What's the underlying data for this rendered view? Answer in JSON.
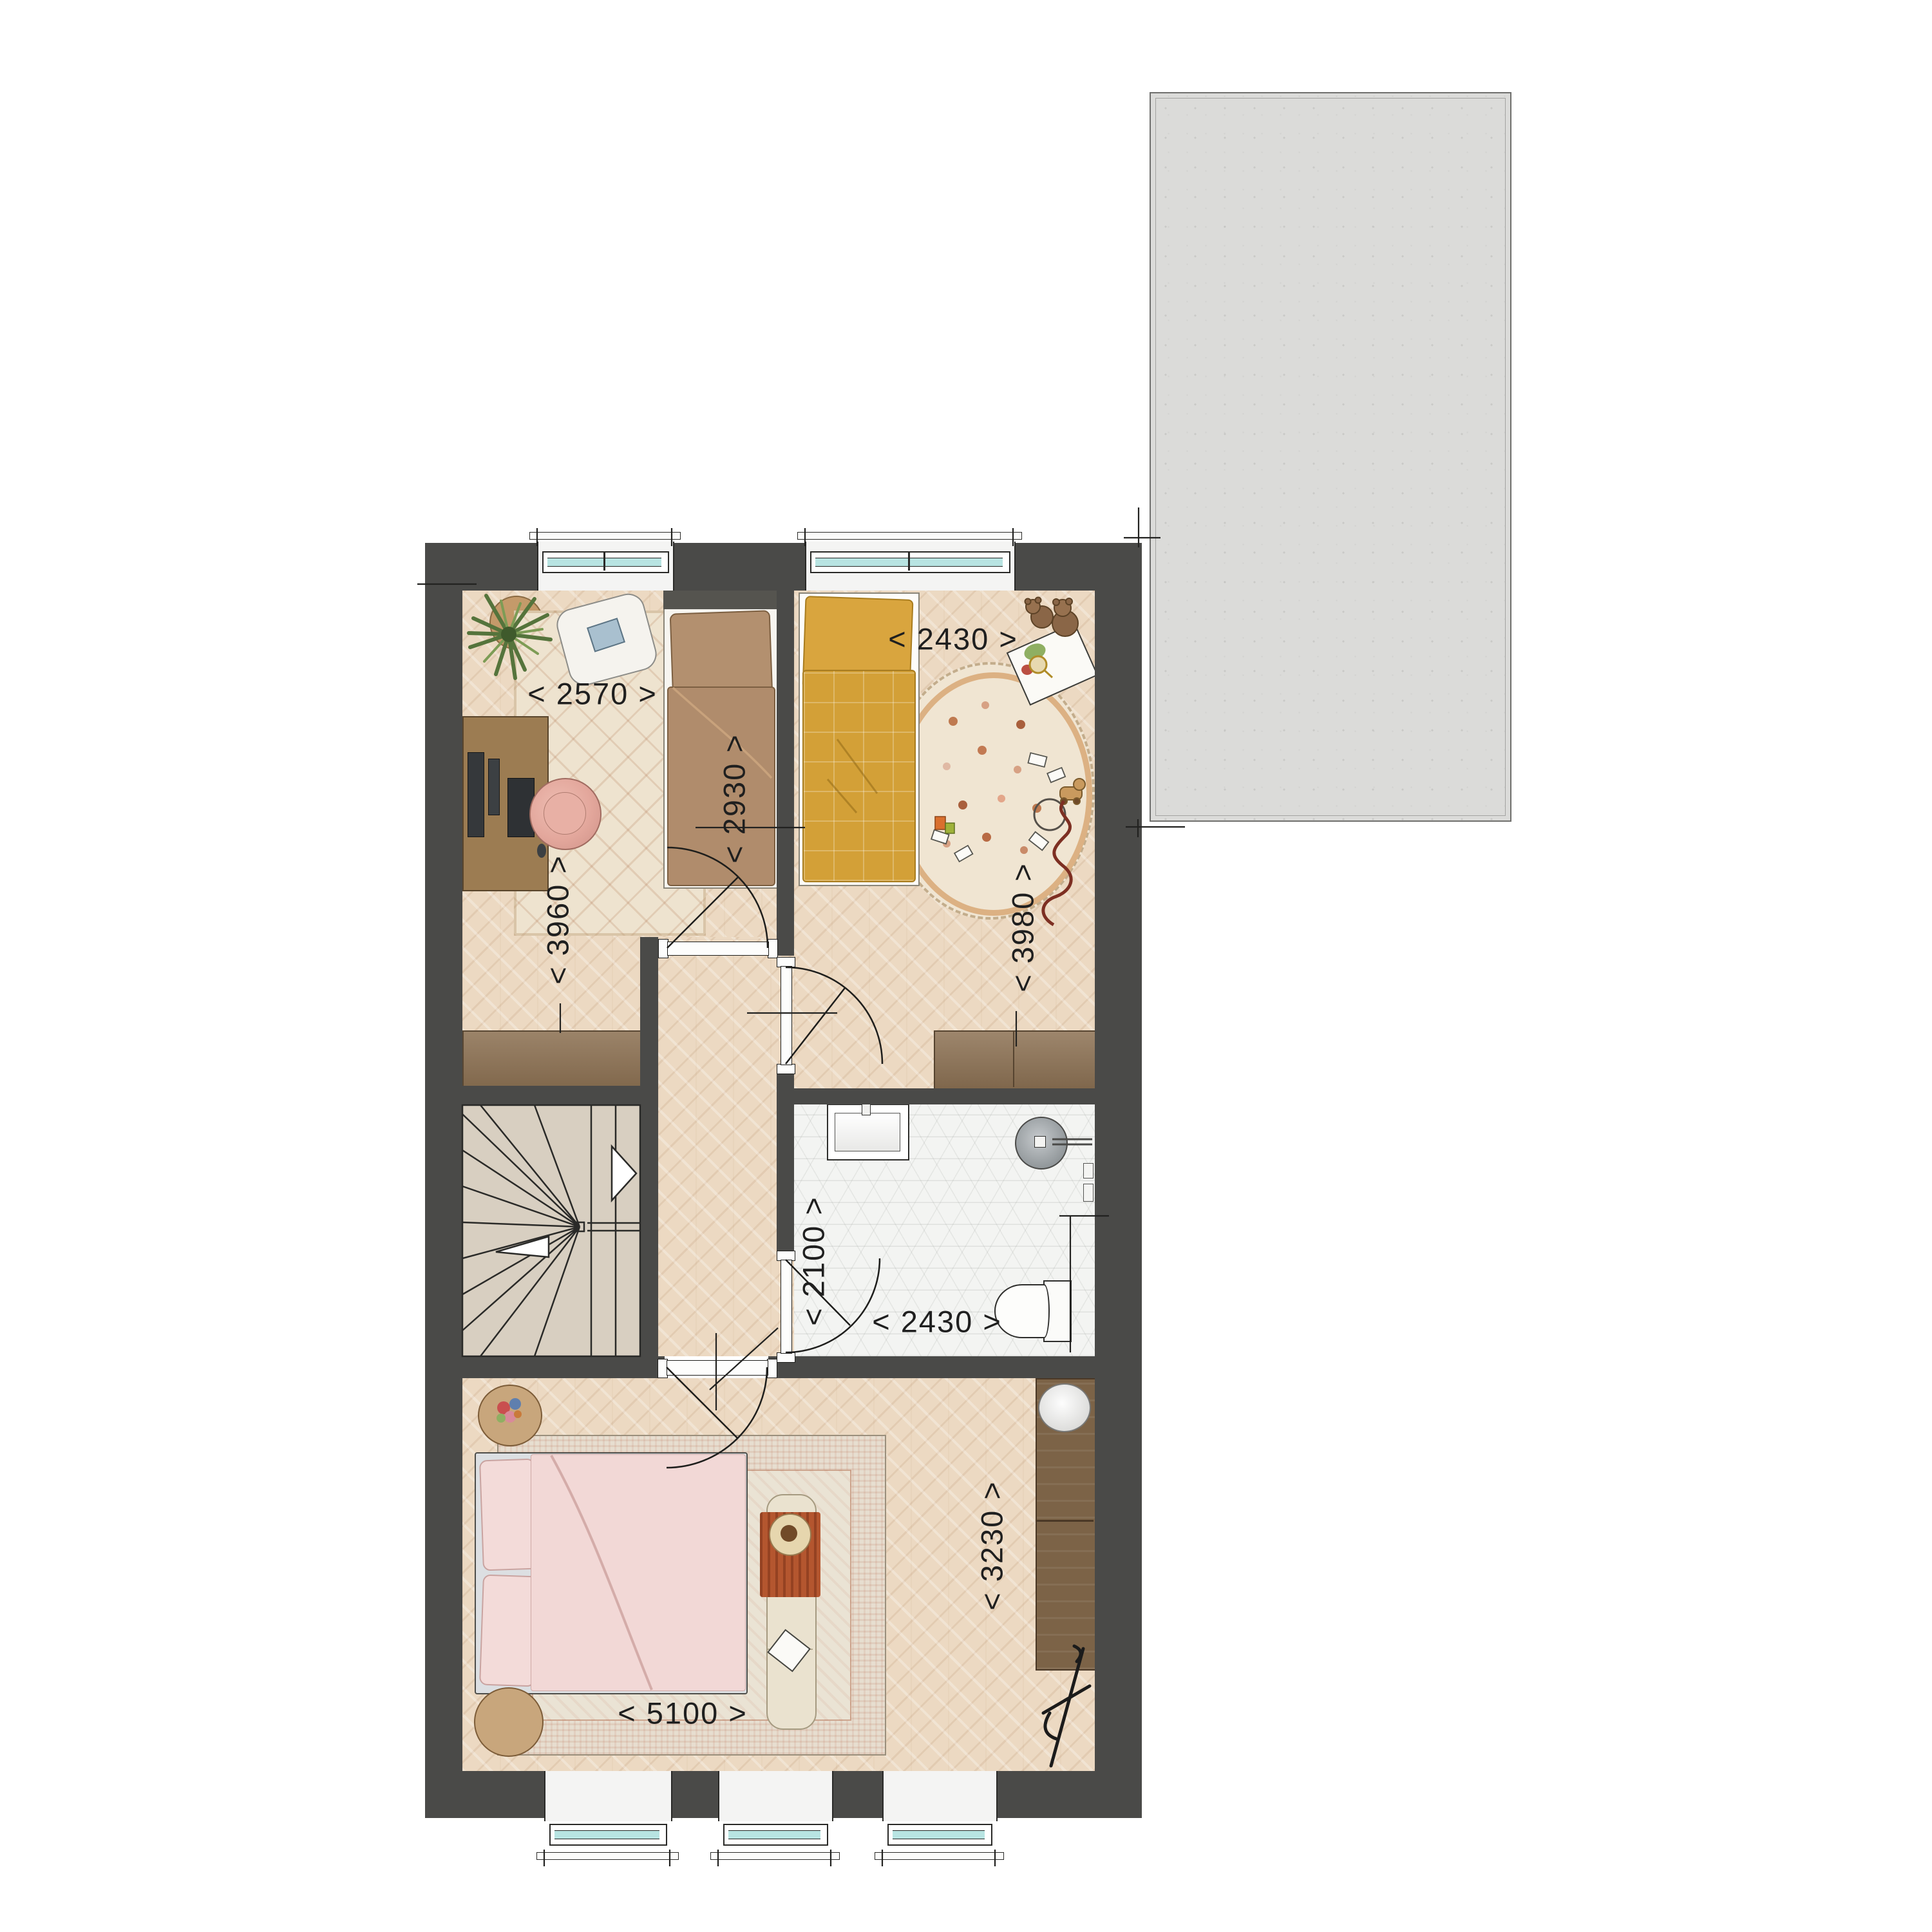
{
  "colors": {
    "wall": "#4a4a48",
    "wood-floor": "#ecd9c2",
    "tile-floor": "#f3f4f2",
    "stair-floor": "#d8cfc1",
    "terrace": "#dbdbd9",
    "furniture-wood": "#8d7254",
    "wardrobe-wood": "#7c6347",
    "window-glass": "#b8e4e2",
    "master-bed": "#f2d8d6",
    "kids-bed": "#d3a037",
    "guest-bed": "#b08c6c",
    "throw": "#b4562f",
    "chair": "#e3a79c",
    "dim-text": "#1f1f1f"
  },
  "labels": [
    {
      "id": "bedroom1-width",
      "text": "< 2570 >",
      "orientation": "horizontal"
    },
    {
      "id": "bedroom1-bed-length",
      "text": "< 2930 >",
      "orientation": "vertical"
    },
    {
      "id": "kidsroom-width",
      "text": "< 2430 >",
      "orientation": "horizontal"
    },
    {
      "id": "kidsroom-depth",
      "text": "< 3980 >",
      "orientation": "vertical"
    },
    {
      "id": "bedroom1-depth",
      "text": "< 3960 >",
      "orientation": "vertical"
    },
    {
      "id": "bathroom-depth",
      "text": "< 2100 >",
      "orientation": "vertical"
    },
    {
      "id": "bathroom-width",
      "text": "< 2430 >",
      "orientation": "horizontal"
    },
    {
      "id": "master-width",
      "text": "< 5100 >",
      "orientation": "horizontal"
    },
    {
      "id": "master-depth",
      "text": "< 3230 >",
      "orientation": "vertical"
    }
  ],
  "furniture_visible": [
    "double-bed",
    "single-bed",
    "kids-bed",
    "desk",
    "monitors",
    "office-chair",
    "lounge-chair",
    "potted-plant",
    "sideboard",
    "bedroom-rug",
    "kids-round-rug",
    "master-rug",
    "washbasin",
    "shower",
    "toilet",
    "chest-of-drawers",
    "wardrobe",
    "laundry-basket",
    "valet-stand",
    "bench-with-throw",
    "nightstands",
    "winder-staircase",
    "teddy-bears",
    "picture-book",
    "toys",
    "pull-toy",
    "toy-snake"
  ]
}
